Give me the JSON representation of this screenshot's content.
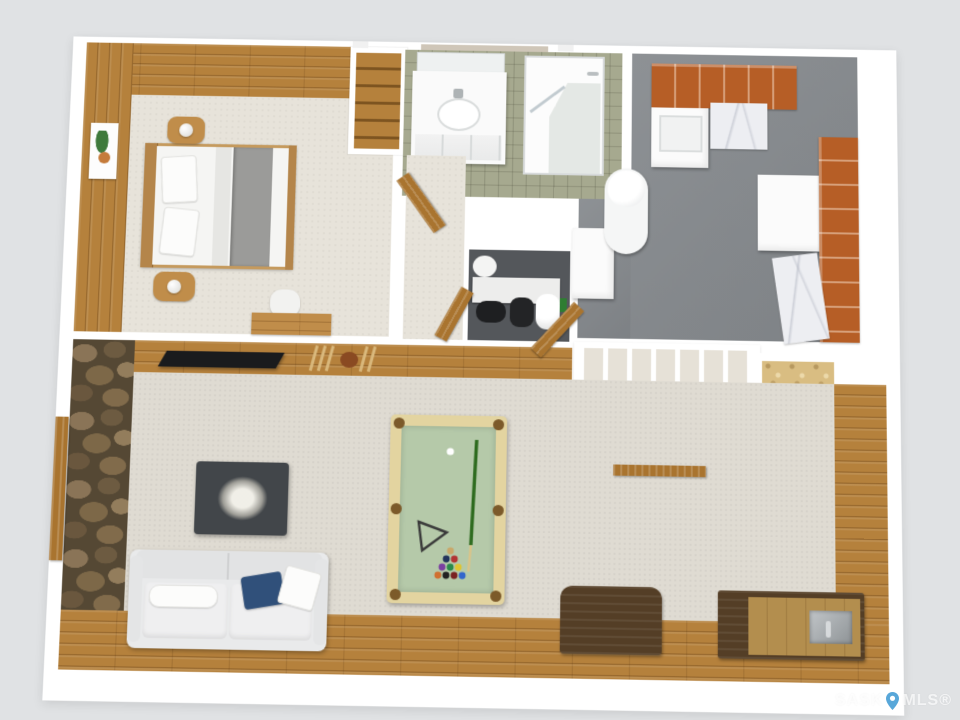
{
  "watermark": {
    "left": "SASK",
    "right": "MLS®",
    "icon": "map-pin-icon"
  },
  "palette": {
    "bg": "#e0e2e4",
    "wall": "#ffffff",
    "wood": "#b5813c",
    "wood_warm": "#c08d4a",
    "carpet": "#e7e3da",
    "rec_carpet": "#dfdbd2",
    "stairs_carpet": "#e6e1d7",
    "gray_floor": "#85898d",
    "dark_floor": "#54575b",
    "tile": "#a6a98f",
    "cabinet": "#b65e26",
    "marble": "#edeef2",
    "stone_base": "#554834",
    "felt": "#b5c9a9",
    "rail": "#e3d4a0",
    "pocket": "#7c5a2a",
    "osb": "#d9bd82",
    "tv": "#1a1b1d",
    "sofa": "#e9eaeb",
    "navy_pillow": "#30507a",
    "coffee_table": "#42464a",
    "walnut": "#543e26",
    "bar_top": "#b38e4e",
    "steel": "#a8acaf",
    "door_wood": "#a9742f",
    "pin": "#58a7d9"
  },
  "floor_plan": {
    "view": "3d-dollhouse-top-down-render",
    "rooms": [
      {
        "name": "bedroom",
        "floor": "beige-carpet",
        "walls": "knotty-pine-panelling",
        "furniture": [
          "double-bed-white-gray-bedding",
          "nightstand-with-lamp",
          "nightstand-with-lamp",
          "plant-wall-art",
          "desk",
          "chair"
        ]
      },
      {
        "name": "closet",
        "floor": "wood",
        "furniture": [
          "wood-shelving"
        ]
      },
      {
        "name": "bathroom",
        "floor": "green-tile",
        "furniture": [
          "white-vanity-with-sink",
          "mirror",
          "corner-glass-shower",
          "wood-door"
        ]
      },
      {
        "name": "hallway",
        "floor": "beige-carpet",
        "furniture": []
      },
      {
        "name": "laundry-utility-room",
        "floor": "gray-vinyl",
        "furniture": [
          "orange-upper-cabinets",
          "laundry-sink-unit",
          "marble-counter",
          "chest-freezer",
          "orange-side-cabinets",
          "marble-side-counter",
          "water-heater",
          "furnace"
        ]
      },
      {
        "name": "mechanical-room",
        "floor": "dark-gray",
        "furniture": [
          "utility-tanks",
          "wood-door"
        ]
      },
      {
        "name": "staircase",
        "floor": "carpeted-treads",
        "furniture": [
          "under-stair-wire-shelving",
          "stored-door-slab"
        ]
      },
      {
        "name": "storage-room",
        "floor": "osb-subfloor",
        "furniture": []
      },
      {
        "name": "rec-room",
        "floor": "carpet-with-wood-plank-border",
        "walls": "stone-feature-wall",
        "furniture": [
          "wall-mounted-tv",
          "pool-cue-rack",
          "pool-table-with-cue-triangle-balls",
          "sofa-with-pillows",
          "dark-coffee-table-with-centerpiece",
          "walnut-media-console",
          "wet-bar-with-steel-sink",
          "exterior-wood-door"
        ]
      }
    ],
    "pool_ball_colors": [
      "#c9a86a",
      "#b23333",
      "#23345c",
      "#2a8a4a",
      "#ddc533",
      "#7a3fa0",
      "#d07030",
      "#222222",
      "#7a2222",
      "#3366cc"
    ]
  }
}
